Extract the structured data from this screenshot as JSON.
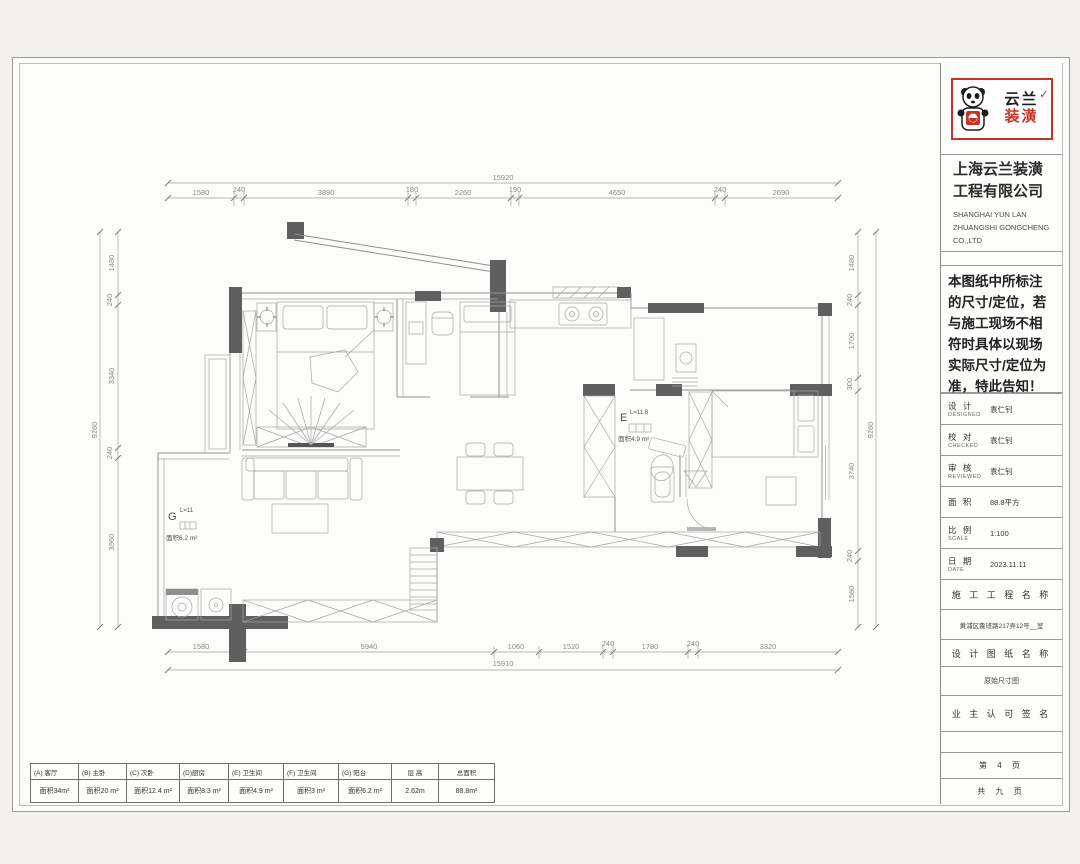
{
  "colors": {
    "accent_red": "#c63427",
    "wall_gray": "#5f5f5f"
  },
  "title_block": {
    "logo_text_top": "云兰",
    "logo_check": "✓",
    "logo_text_bottom": "装潢",
    "company_cn_line1": "上海云兰装潢",
    "company_cn_line2": "工程有限公司",
    "company_en_line1": "SHANGHAI YUN LAN",
    "company_en_line2": "ZHUANGSHI GONGCHENG",
    "company_en_line3": "CO.,LTD",
    "notice": "本图纸中所标注的尺寸/定位，若与施工现场不相符时具体以现场实际尺寸/定位为准，特此告知！",
    "fields": [
      {
        "label": "设 计",
        "sub": "DESIGNED",
        "value": "袁仁钊"
      },
      {
        "label": "校 对",
        "sub": "CHECKED",
        "value": "袁仁钊"
      },
      {
        "label": "审 核",
        "sub": "REVIEWED",
        "value": "袁仁钊"
      },
      {
        "label": "面 积",
        "sub": "",
        "value": "88.8平方"
      },
      {
        "label": "比 例",
        "sub": "SCALE",
        "value": "1:100"
      },
      {
        "label": "日 期",
        "sub": "DATE",
        "value": "2023.11.11"
      }
    ],
    "project_label": "施 工 工 程 名 称",
    "project_value": "黄浦区鲁班路217弄12号__室",
    "drawing_label": "设 计 图 纸 名 称",
    "drawing_value": "原始尺寸图",
    "sign_label": "业 主 认 可 签 名",
    "page_current": "第 4 页",
    "page_total": "共 九 页"
  },
  "legend": {
    "cells": [
      {
        "h": "(A) 客厅",
        "v": "面积34m²"
      },
      {
        "h": "(B) 主卧",
        "v": "面积20 m²"
      },
      {
        "h": "(C) 次卧",
        "v": "面积12.4 m²"
      },
      {
        "h": "(D)厨房",
        "v": "面积8.3 m²"
      },
      {
        "h": "(E) 卫生间",
        "v": "面积4.9 m²"
      },
      {
        "h": "(F) 卫生间",
        "v": "面积3 m²"
      },
      {
        "h": "(G) 阳台",
        "v": "面积6.2 m²"
      },
      {
        "h": "层 高",
        "v": "2.62m"
      },
      {
        "h": "总面积",
        "v": "88.8m²"
      }
    ]
  },
  "plan": {
    "dims": {
      "top_total": "15920",
      "top": [
        "1580",
        "240",
        "3890",
        "180",
        "2260",
        "190",
        "4650",
        "240",
        "2690"
      ],
      "bottom_total": "15910",
      "bottom": [
        "1580",
        "5940",
        "1060",
        "1520",
        "240",
        "1780",
        "240",
        "3320"
      ],
      "left_total": "9260",
      "left": [
        "1480",
        "240",
        "3340",
        "240",
        "3960"
      ],
      "right_total": "9260",
      "right": [
        "1480",
        "240",
        "1700",
        "300",
        "3740",
        "240",
        "1560"
      ]
    },
    "labels": {
      "balcony_code": "G",
      "balcony_sup": "L=11",
      "balcony_area": "面积6.2 m²",
      "bath_code": "E",
      "bath_sup": "L=11.8",
      "bath_area": "面积4.9 m²"
    }
  }
}
